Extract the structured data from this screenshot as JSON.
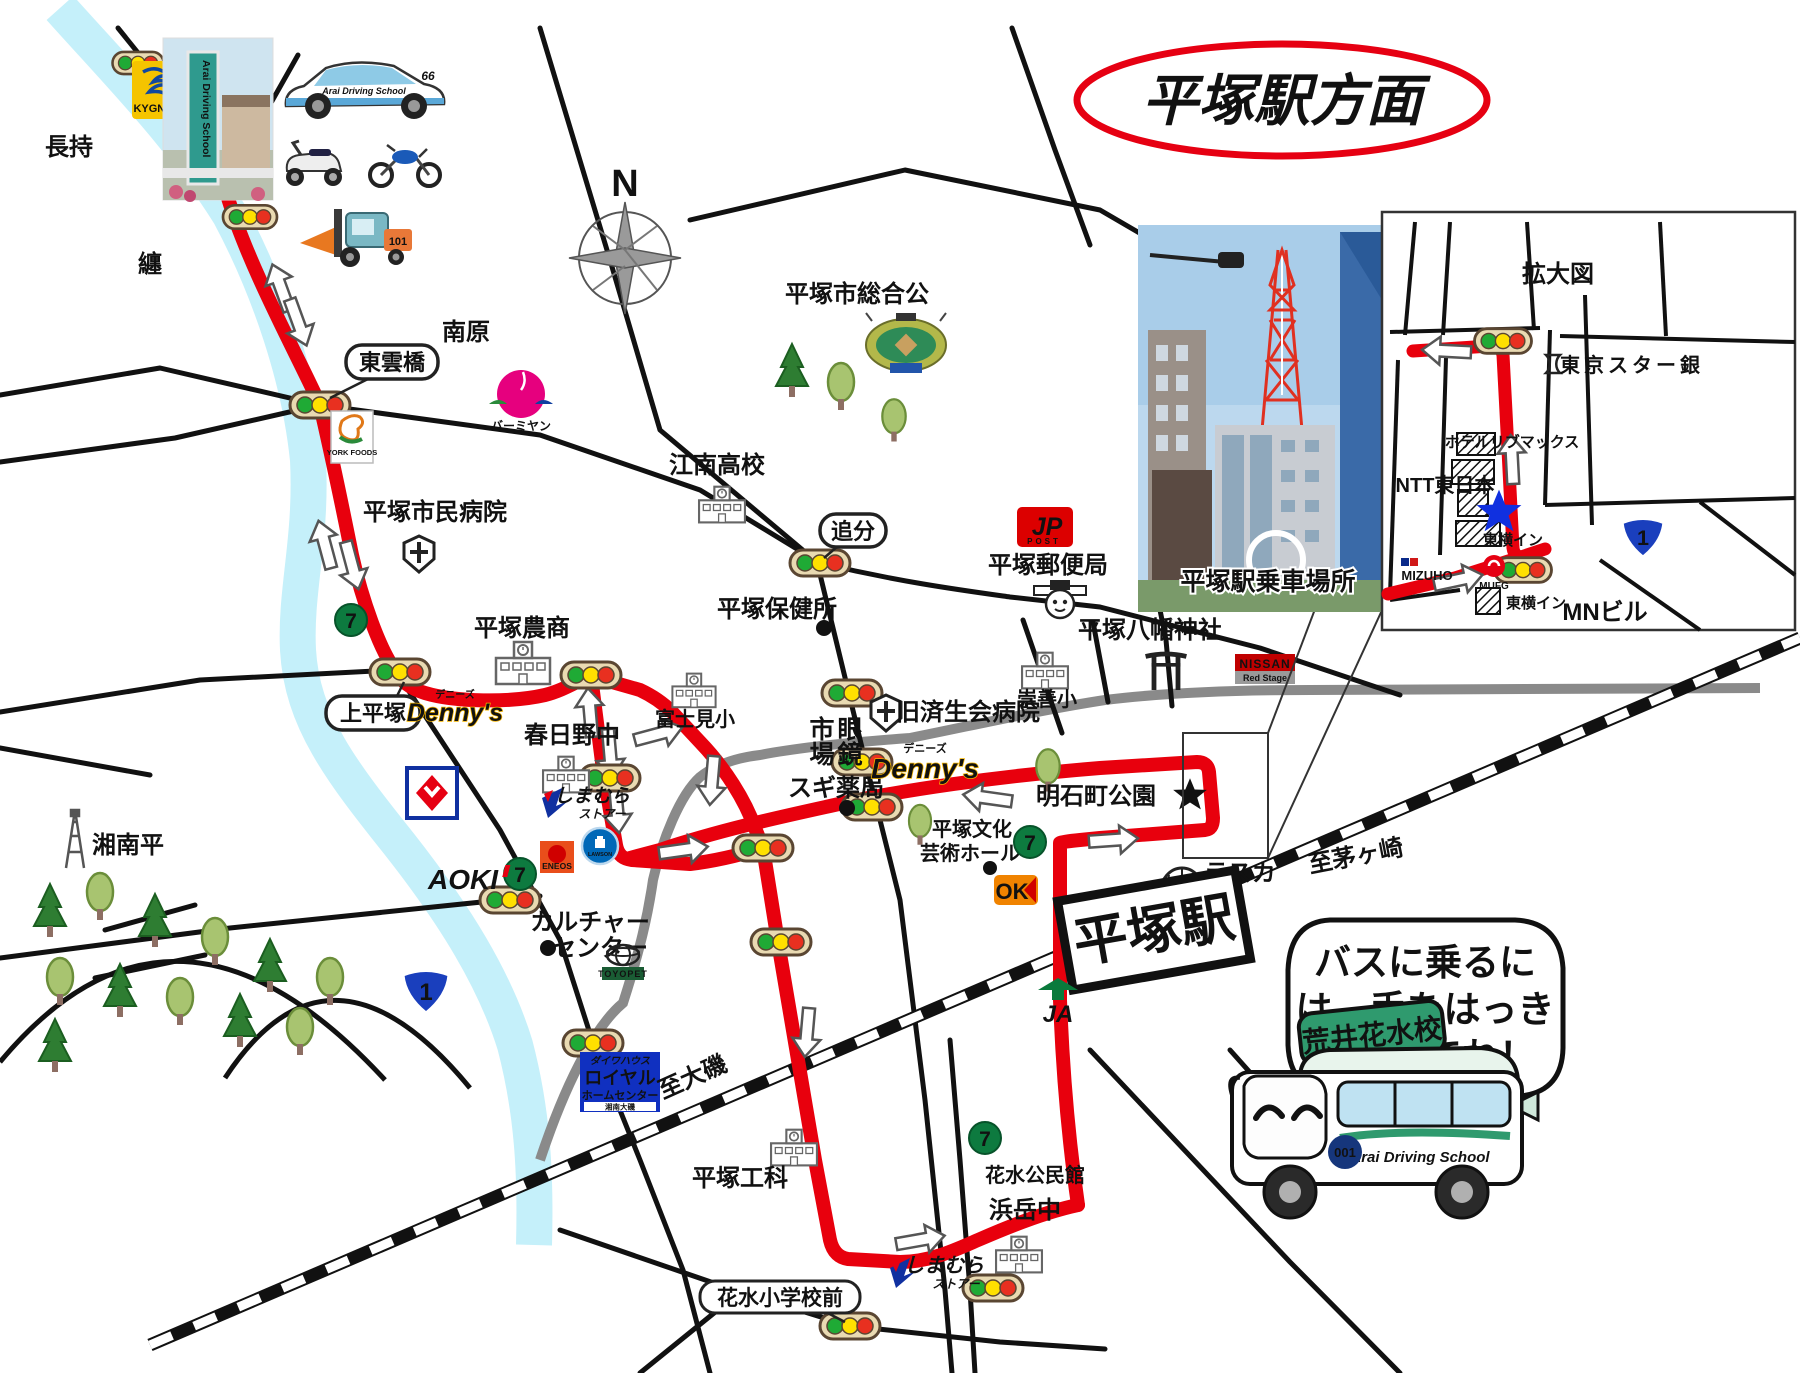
{
  "title": "平塚駅方面",
  "colors": {
    "route": "#e8000d",
    "river": "#c5f0fa",
    "gray_road": "#8a8a8a",
    "accent": "#e60012",
    "route1_blue": "#1a3fbd"
  },
  "t": {
    "compass_n": "N",
    "nagamochi": "長持",
    "matoi": "纏",
    "minamihara": "南原",
    "shinonome": "東雲橋",
    "kamihiratsuka": "上平塚",
    "oiwake": "追分",
    "hanamizu_mae": "花水小学校前",
    "shimin_byoin": "平塚市民病院",
    "nosho": "平塚農商",
    "kasugano": "春日野中",
    "fujimi": "富士見小",
    "konan": "江南高校",
    "hokenjo": "平塚保健所",
    "sogo_koen": "平塚市総合公",
    "yubinkyoku": "平塚郵便局",
    "suzen": "崇善小",
    "hachiman": "平塚八幡神社",
    "saiseikai": "旧済生会病院",
    "sugi": "スギ薬局",
    "akashicho": "明石町公園",
    "bunka1": "平塚文化",
    "bunka2": "芸術ホール",
    "lasca": "ラスカ",
    "chigasaki": "至茅ヶ崎",
    "eki": "平塚駅",
    "shonandaira": "湘南平",
    "culture1": "カルチャー",
    "culture2": "センター",
    "oiso": "至大磯",
    "koka": "平塚工科",
    "kominkan": "花水公民館",
    "hamadake": "浜岳中",
    "boarding": "平塚駅乗車場所",
    "kakudaizu": "拡大図",
    "tokyostar": "東京スター銀",
    "livemax": "ホテルリブマックス",
    "ntt": "NTT東日本",
    "toyoko": "東横イン",
    "mn": "MNビル",
    "one": "1",
    "bubble1": "バスに乗るに",
    "bubble2": "は、手をはっき",
    "bubble3": "り上げてね！"
  },
  "logos": {
    "kygnus": "KYGNUS",
    "york": "YORK FOODS",
    "seven": "7",
    "dennys": "Denny's",
    "dennys_kana": "デニーズ",
    "eneos": "ENEOS",
    "lawson": "LAWSON",
    "aoki": "AOKI",
    "shimamura1": "しまむら",
    "shimamura2": "ストアー",
    "ok": "OK",
    "nissan": "NISSAN",
    "redstage": "Red Stage",
    "ja": "JA",
    "toyopet": "TOYOPET",
    "mizuho": "MIZUHO",
    "mufg": "MUFG",
    "jp": "JP",
    "post": "POST",
    "megane1": "眼鏡",
    "megane2": "市場",
    "bamiyan": "バーミヤン",
    "royal1": "ダイワハウス",
    "royal2": "ロイヤル",
    "royal3": "ホームセンター",
    "royal4": "湘南大磯",
    "bus_sign": "荒井花水校",
    "bus_school": "Arai Driving School",
    "bus_no": "001",
    "car_school": "Arai Driving School",
    "car_no": "66",
    "fork_no": "101",
    "sign_school": "Arai Driving School"
  }
}
